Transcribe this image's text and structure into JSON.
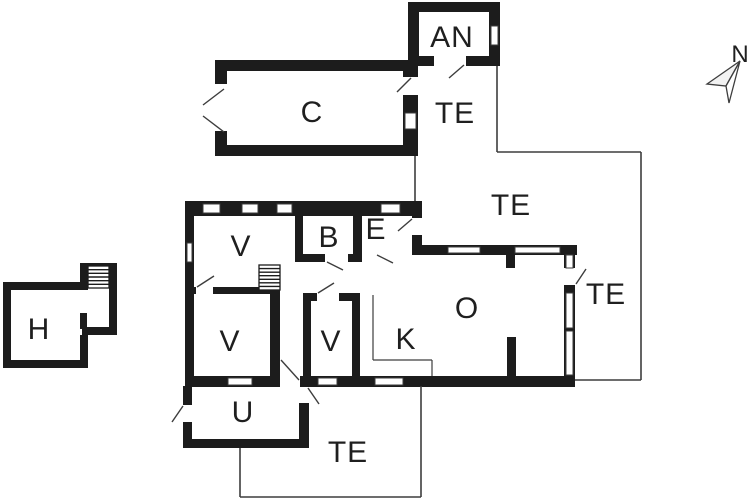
{
  "title": "floor-plan",
  "colors": {
    "background": "#ffffff",
    "wall": "#1c1c1c",
    "thin_line": "#3d3d3d",
    "label": "#1f1f1f"
  },
  "compass": {
    "label": "N"
  },
  "rooms": [
    {
      "id": "an",
      "label": "AN",
      "x": 452,
      "y": 47,
      "size": 30
    },
    {
      "id": "c",
      "label": "C",
      "x": 312,
      "y": 122,
      "size": 30
    },
    {
      "id": "te-1",
      "label": "TE",
      "x": 455,
      "y": 123,
      "size": 30
    },
    {
      "id": "te-2",
      "label": "TE",
      "x": 511,
      "y": 215,
      "size": 30
    },
    {
      "id": "te-3",
      "label": "TE",
      "x": 606,
      "y": 304,
      "size": 30
    },
    {
      "id": "te-4",
      "label": "TE",
      "x": 348,
      "y": 462,
      "size": 30
    },
    {
      "id": "v-1",
      "label": "V",
      "x": 241,
      "y": 256,
      "size": 30
    },
    {
      "id": "b",
      "label": "B",
      "x": 329,
      "y": 247,
      "size": 30
    },
    {
      "id": "e",
      "label": "E",
      "x": 376,
      "y": 239,
      "size": 30
    },
    {
      "id": "v-2",
      "label": "V",
      "x": 230,
      "y": 351,
      "size": 30
    },
    {
      "id": "v-3",
      "label": "V",
      "x": 331,
      "y": 351,
      "size": 30
    },
    {
      "id": "k",
      "label": "K",
      "x": 406,
      "y": 349,
      "size": 30
    },
    {
      "id": "o",
      "label": "O",
      "x": 467,
      "y": 318,
      "size": 30
    },
    {
      "id": "u",
      "label": "U",
      "x": 243,
      "y": 422,
      "size": 30
    },
    {
      "id": "h",
      "label": "H",
      "x": 39,
      "y": 339,
      "size": 30
    }
  ],
  "plan": {
    "walls": [
      {
        "id": "main-top",
        "x": 185,
        "y": 201,
        "w": 237,
        "h": 15
      },
      {
        "id": "main-left",
        "x": 185,
        "y": 201,
        "w": 9,
        "h": 186
      },
      {
        "id": "main-bottom",
        "x": 185,
        "y": 376,
        "w": 390,
        "h": 11
      },
      {
        "id": "e-right",
        "x": 412,
        "y": 201,
        "w": 10,
        "h": 47
      },
      {
        "id": "o-top",
        "x": 412,
        "y": 245,
        "w": 165,
        "h": 10
      },
      {
        "id": "o-right",
        "x": 564,
        "y": 245,
        "w": 11,
        "h": 142
      },
      {
        "id": "b-left",
        "x": 295,
        "y": 201,
        "w": 8,
        "h": 56
      },
      {
        "id": "b-e-divider",
        "x": 353,
        "y": 201,
        "w": 9,
        "h": 61
      },
      {
        "id": "b-bottom",
        "x": 295,
        "y": 254,
        "w": 58,
        "h": 8
      },
      {
        "id": "v-divider",
        "x": 193,
        "y": 287,
        "w": 87,
        "h": 7
      },
      {
        "id": "v2-right",
        "x": 270,
        "y": 290,
        "w": 10,
        "h": 96
      },
      {
        "id": "v3-top",
        "x": 303,
        "y": 293,
        "w": 57,
        "h": 8
      },
      {
        "id": "v3-left",
        "x": 303,
        "y": 293,
        "w": 8,
        "h": 93
      },
      {
        "id": "v3-right",
        "x": 352,
        "y": 293,
        "w": 8,
        "h": 93
      },
      {
        "id": "o-stub-top",
        "x": 506,
        "y": 255,
        "w": 9,
        "h": 13
      },
      {
        "id": "o-stub-bottom",
        "x": 507,
        "y": 337,
        "w": 9,
        "h": 40
      },
      {
        "id": "u-left",
        "x": 183,
        "y": 386,
        "w": 9,
        "h": 61
      },
      {
        "id": "u-bottom",
        "x": 183,
        "y": 439,
        "w": 125,
        "h": 9
      },
      {
        "id": "u-right",
        "x": 299,
        "y": 403,
        "w": 10,
        "h": 45
      },
      {
        "id": "c-top",
        "x": 215,
        "y": 60,
        "w": 203,
        "h": 11
      },
      {
        "id": "c-left",
        "x": 215,
        "y": 60,
        "w": 12,
        "h": 96
      },
      {
        "id": "c-bottom",
        "x": 215,
        "y": 145,
        "w": 203,
        "h": 11
      },
      {
        "id": "c-right",
        "x": 403,
        "y": 60,
        "w": 15,
        "h": 96
      },
      {
        "id": "an-top",
        "x": 408,
        "y": 2,
        "w": 92,
        "h": 10
      },
      {
        "id": "an-left",
        "x": 408,
        "y": 2,
        "w": 11,
        "h": 64
      },
      {
        "id": "an-right",
        "x": 489,
        "y": 2,
        "w": 11,
        "h": 64
      },
      {
        "id": "an-bottom",
        "x": 408,
        "y": 56,
        "w": 92,
        "h": 10
      },
      {
        "id": "h-top",
        "x": 3,
        "y": 282,
        "w": 83,
        "h": 8
      },
      {
        "id": "h-left",
        "x": 3,
        "y": 282,
        "w": 8,
        "h": 86
      },
      {
        "id": "h-bottom",
        "x": 3,
        "y": 360,
        "w": 85,
        "h": 8
      },
      {
        "id": "h-right-lower",
        "x": 80,
        "y": 335,
        "w": 8,
        "h": 33
      },
      {
        "id": "h-ext-left",
        "x": 80,
        "y": 263,
        "w": 8,
        "h": 27
      },
      {
        "id": "h-ext-top",
        "x": 80,
        "y": 263,
        "w": 37,
        "h": 8
      },
      {
        "id": "h-ext-right",
        "x": 109,
        "y": 263,
        "w": 8,
        "h": 72
      },
      {
        "id": "h-ext-bottom",
        "x": 82,
        "y": 327,
        "w": 35,
        "h": 8
      },
      {
        "id": "h-stub",
        "x": 80,
        "y": 313,
        "w": 7,
        "h": 16
      }
    ],
    "door_openings": [
      {
        "id": "e-right-door",
        "x": 411,
        "y": 218,
        "w": 12,
        "h": 17
      },
      {
        "id": "e-bottom-door",
        "x": 377,
        "y": 244,
        "w": 20,
        "h": 12
      },
      {
        "id": "b-door",
        "x": 325,
        "y": 253,
        "w": 23,
        "h": 10
      },
      {
        "id": "v-divider-door",
        "x": 196,
        "y": 286,
        "w": 17,
        "h": 9
      },
      {
        "id": "v3-door",
        "x": 317,
        "y": 292,
        "w": 22,
        "h": 10
      },
      {
        "id": "hall-exit-door",
        "x": 280,
        "y": 375,
        "w": 20,
        "h": 13
      },
      {
        "id": "u-left-door",
        "x": 182,
        "y": 405,
        "w": 11,
        "h": 17
      },
      {
        "id": "o-right-door",
        "x": 563,
        "y": 268,
        "w": 13,
        "h": 17
      },
      {
        "id": "an-door",
        "x": 434,
        "y": 55,
        "w": 32,
        "h": 12
      },
      {
        "id": "c-right-door",
        "x": 402,
        "y": 77,
        "w": 17,
        "h": 18
      },
      {
        "id": "c-left-opening",
        "x": 214,
        "y": 84,
        "w": 14,
        "h": 47
      }
    ],
    "windows": [
      {
        "id": "top-w1",
        "x": 203,
        "y": 204,
        "w": 17,
        "h": 9
      },
      {
        "id": "top-w2",
        "x": 242,
        "y": 204,
        "w": 16,
        "h": 9
      },
      {
        "id": "top-w3",
        "x": 277,
        "y": 204,
        "w": 15,
        "h": 9
      },
      {
        "id": "top-w4",
        "x": 381,
        "y": 204,
        "w": 19,
        "h": 9
      },
      {
        "id": "left-w1",
        "x": 187,
        "y": 243,
        "w": 5,
        "h": 19
      },
      {
        "id": "bottom-w1",
        "x": 228,
        "y": 378,
        "w": 24,
        "h": 7
      },
      {
        "id": "bottom-w2",
        "x": 318,
        "y": 378,
        "w": 19,
        "h": 7
      },
      {
        "id": "bottom-w3",
        "x": 375,
        "y": 378,
        "w": 28,
        "h": 7
      },
      {
        "id": "o-top-w1",
        "x": 448,
        "y": 247,
        "w": 32,
        "h": 6
      },
      {
        "id": "o-top-w2",
        "x": 515,
        "y": 247,
        "w": 45,
        "h": 6
      },
      {
        "id": "o-right-w1",
        "x": 566,
        "y": 255,
        "w": 7,
        "h": 13
      },
      {
        "id": "o-right-w2",
        "x": 566,
        "y": 293,
        "w": 7,
        "h": 35
      },
      {
        "id": "o-right-w3",
        "x": 566,
        "y": 331,
        "w": 7,
        "h": 44
      },
      {
        "id": "an-w1",
        "x": 491,
        "y": 26,
        "w": 7,
        "h": 19
      },
      {
        "id": "c-right-w1",
        "x": 405,
        "y": 113,
        "w": 11,
        "h": 16
      }
    ],
    "door_swings": [
      {
        "id": "an-swing",
        "x1": 464,
        "y1": 65,
        "x2": 449,
        "y2": 78
      },
      {
        "id": "c-right-swing",
        "x1": 411,
        "y1": 78,
        "x2": 397,
        "y2": 92
      },
      {
        "id": "c-left-swing-a",
        "x1": 224,
        "y1": 89,
        "x2": 203,
        "y2": 105
      },
      {
        "id": "c-left-swing-b",
        "x1": 203,
        "y1": 116,
        "x2": 224,
        "y2": 132
      },
      {
        "id": "e-right-swing",
        "x1": 412,
        "y1": 219,
        "x2": 398,
        "y2": 231
      },
      {
        "id": "e-bottom-swing",
        "x1": 377,
        "y1": 255,
        "x2": 393,
        "y2": 263
      },
      {
        "id": "b-swing",
        "x1": 327,
        "y1": 262,
        "x2": 343,
        "y2": 270
      },
      {
        "id": "v-divider-swing",
        "x1": 197,
        "y1": 287,
        "x2": 214,
        "y2": 276
      },
      {
        "id": "v3-swing",
        "x1": 318,
        "y1": 293,
        "x2": 334,
        "y2": 283
      },
      {
        "id": "hall-exit-swing",
        "x1": 299,
        "y1": 380,
        "x2": 281,
        "y2": 360
      },
      {
        "id": "u-right-swing",
        "x1": 308,
        "y1": 388,
        "x2": 319,
        "y2": 404
      },
      {
        "id": "u-left-swing",
        "x1": 183,
        "y1": 406,
        "x2": 172,
        "y2": 422
      },
      {
        "id": "o-right-swing",
        "x1": 576,
        "y1": 284,
        "x2": 586,
        "y2": 269
      }
    ],
    "terrace_edges": [
      {
        "id": "te-n-1",
        "x1": 497,
        "y1": 66,
        "x2": 497,
        "y2": 152
      },
      {
        "id": "te-n-2",
        "x1": 497,
        "y1": 152,
        "x2": 641,
        "y2": 152
      },
      {
        "id": "te-n-3",
        "x1": 641,
        "y1": 152,
        "x2": 641,
        "y2": 380
      },
      {
        "id": "te-n-4",
        "x1": 641,
        "y1": 380,
        "x2": 575,
        "y2": 380
      },
      {
        "id": "te-n-5",
        "x1": 415,
        "y1": 156,
        "x2": 415,
        "y2": 201
      },
      {
        "id": "te-s-1",
        "x1": 240,
        "y1": 448,
        "x2": 240,
        "y2": 497
      },
      {
        "id": "te-s-2",
        "x1": 240,
        "y1": 497,
        "x2": 421,
        "y2": 497
      },
      {
        "id": "te-s-3",
        "x1": 421,
        "y1": 497,
        "x2": 421,
        "y2": 386
      }
    ],
    "counter_edges": [
      {
        "id": "k-counter-1",
        "x1": 373,
        "y1": 295,
        "x2": 373,
        "y2": 360
      },
      {
        "id": "k-counter-2",
        "x1": 373,
        "y1": 360,
        "x2": 432,
        "y2": 360
      },
      {
        "id": "k-counter-3",
        "x1": 432,
        "y1": 360,
        "x2": 432,
        "y2": 376
      }
    ],
    "stairs": [
      {
        "id": "main-stair",
        "x": 259,
        "y": 265,
        "w": 21,
        "h": 25,
        "steps": 7
      },
      {
        "id": "h-stair",
        "x": 88,
        "y": 266,
        "w": 21,
        "h": 22,
        "steps": 6
      }
    ]
  }
}
